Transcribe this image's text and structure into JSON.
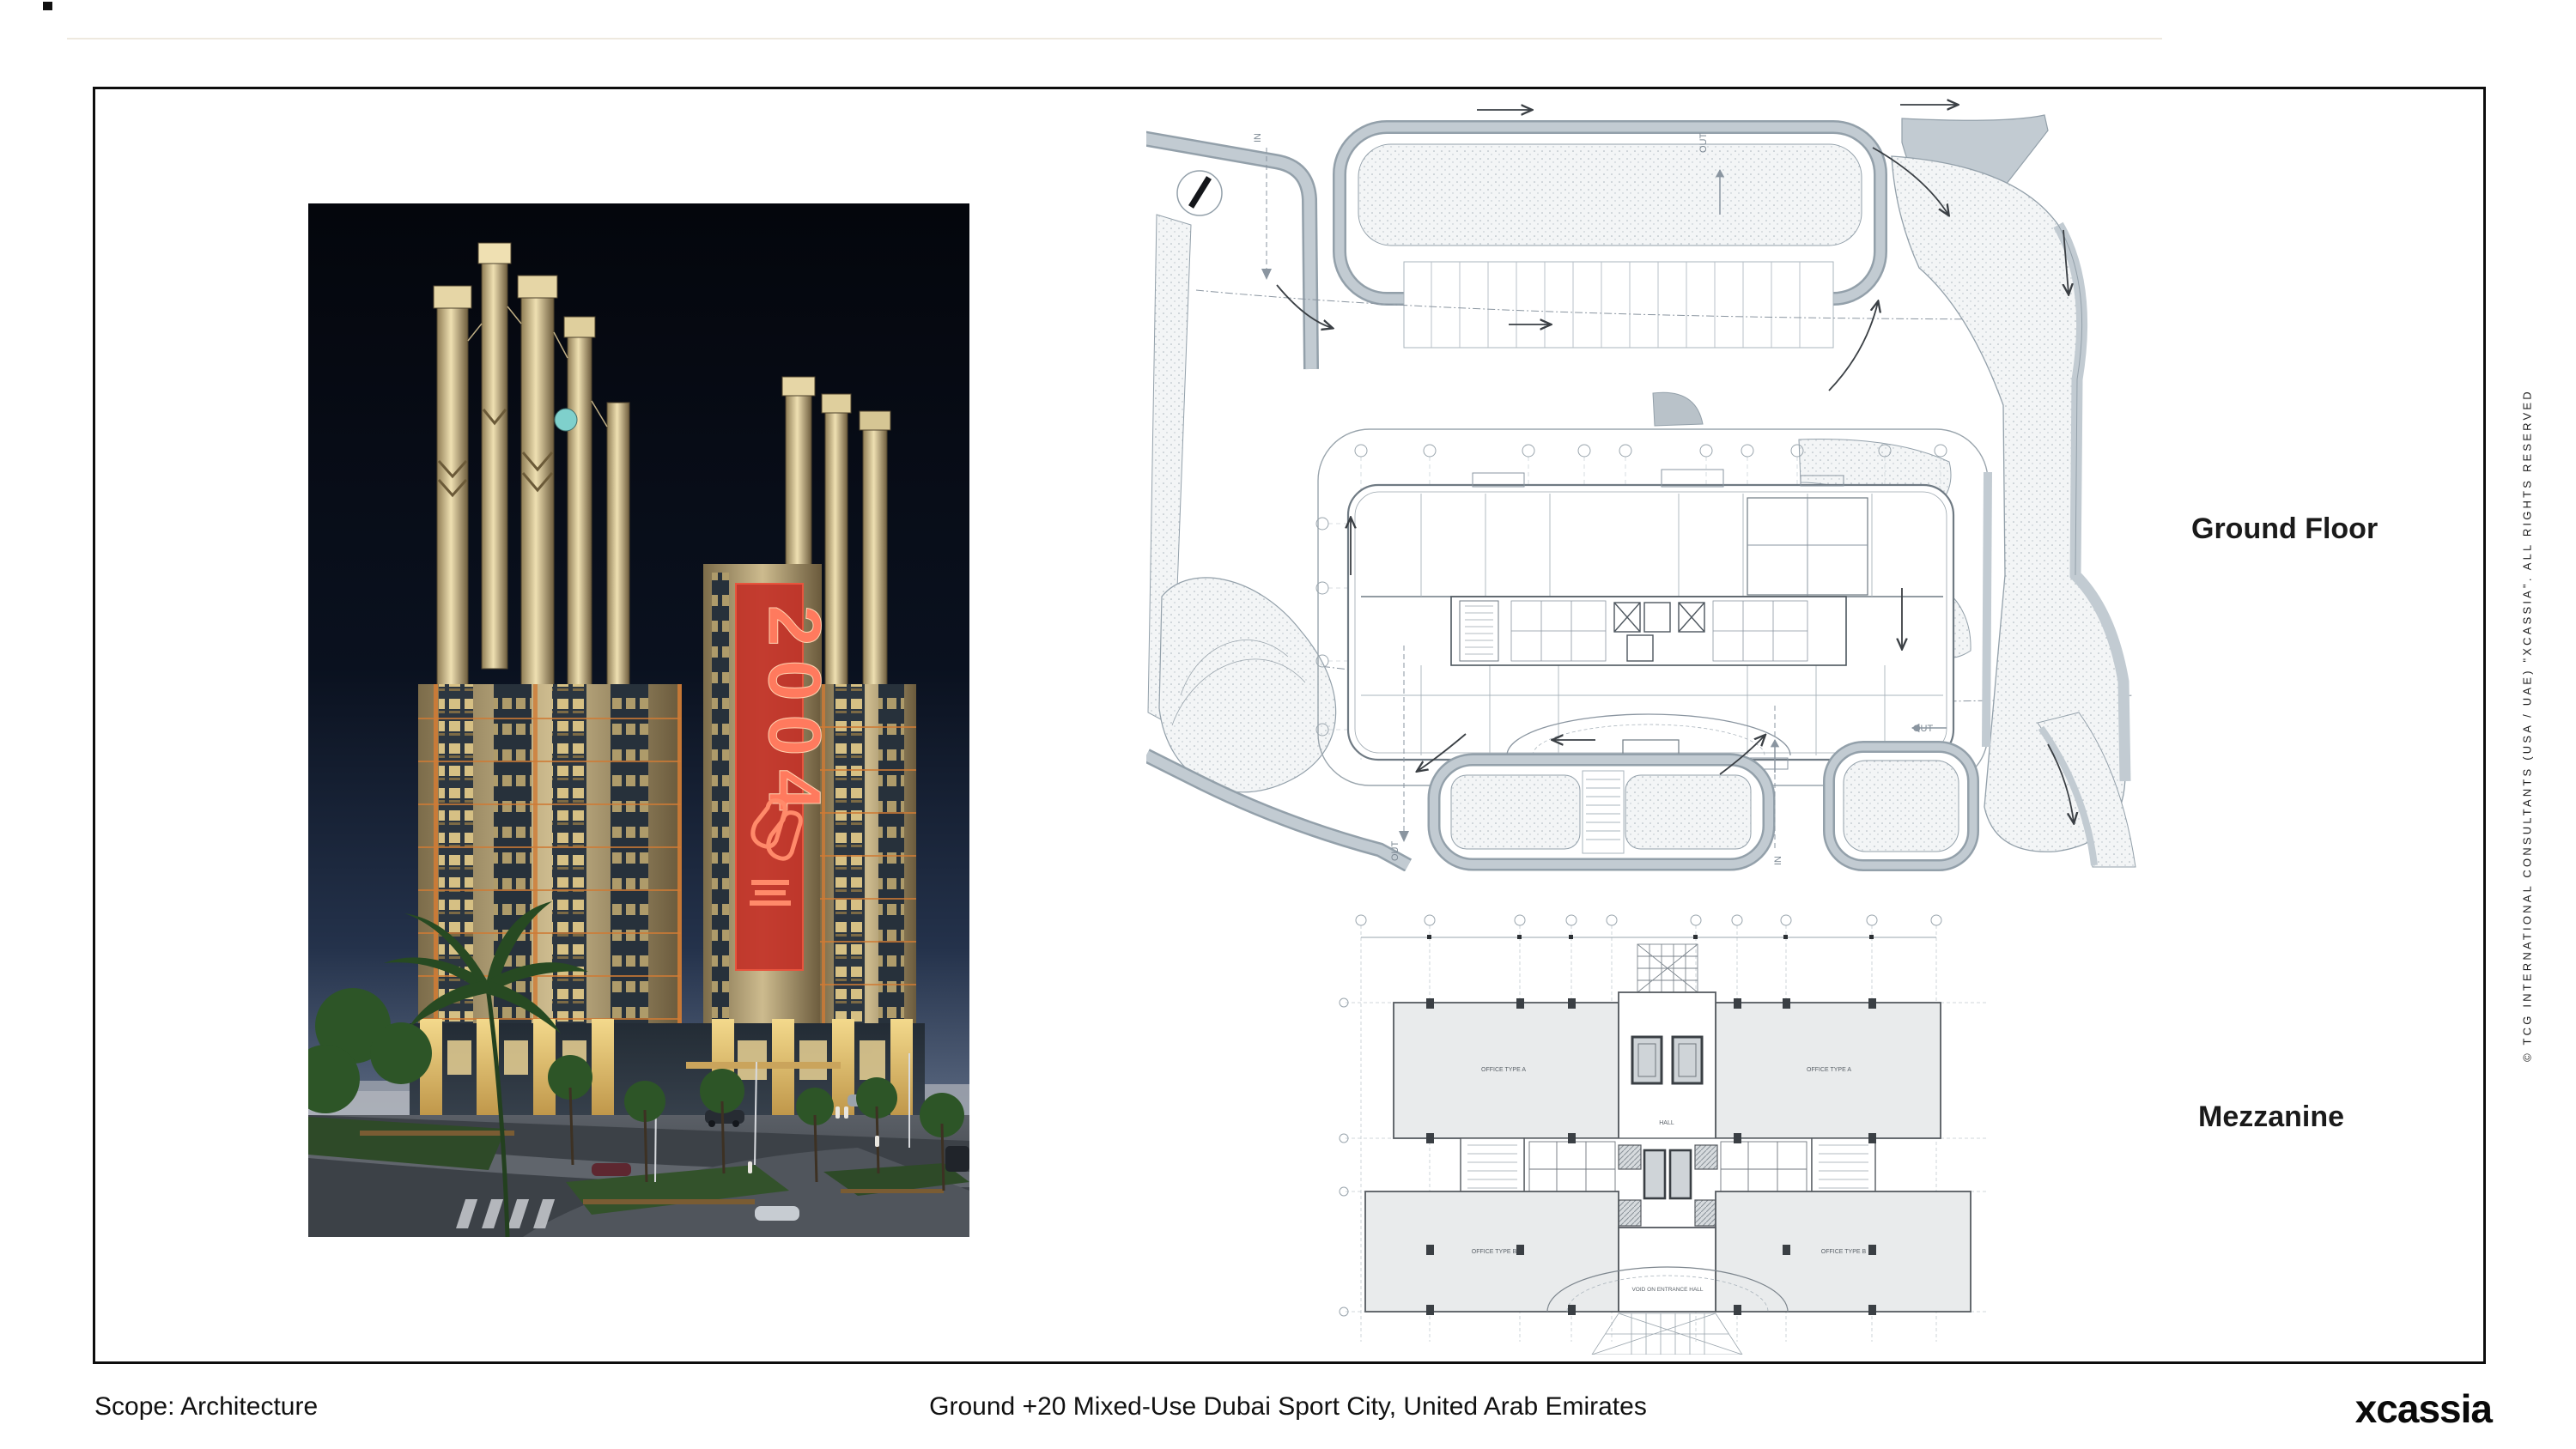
{
  "captions": {
    "ground_floor": "Ground Floor",
    "mezzanine": "Mezzanine"
  },
  "footer": {
    "scope": "Scope: Architecture",
    "title": "Ground +20 Mixed-Use Dubai Sport City, United Arab Emirates",
    "logo_x": "x",
    "logo_rest": "cassia"
  },
  "copyright": "© TCG INTERNATIONAL CONSULTANTS (USA / UAE) \"XCASSIA\". ALL RIGHTS RESERVED",
  "photo": {
    "banner_year": "2004"
  },
  "site_plan": {
    "marker_in": "IN",
    "marker_out": "OUT"
  },
  "mezzanine_plan": {
    "office_a": "OFFICE TYPE A",
    "office_b": "OFFICE TYPE B",
    "hall": "HALL",
    "void_label": "VOID ON ENTRANCE HALL"
  },
  "colors": {
    "banner_red": "#c23127",
    "sky_top": "#05070e",
    "facade_cream": "#d8c79b",
    "window_amber": "#ffd98d",
    "plan_band_gray": "#c2cbd2",
    "plan_line_gray": "#93a0aa",
    "stipple_dot": "#a7b2ba",
    "slab_fill": "#e9ebec",
    "dome_teal": "#7fd0cc"
  }
}
